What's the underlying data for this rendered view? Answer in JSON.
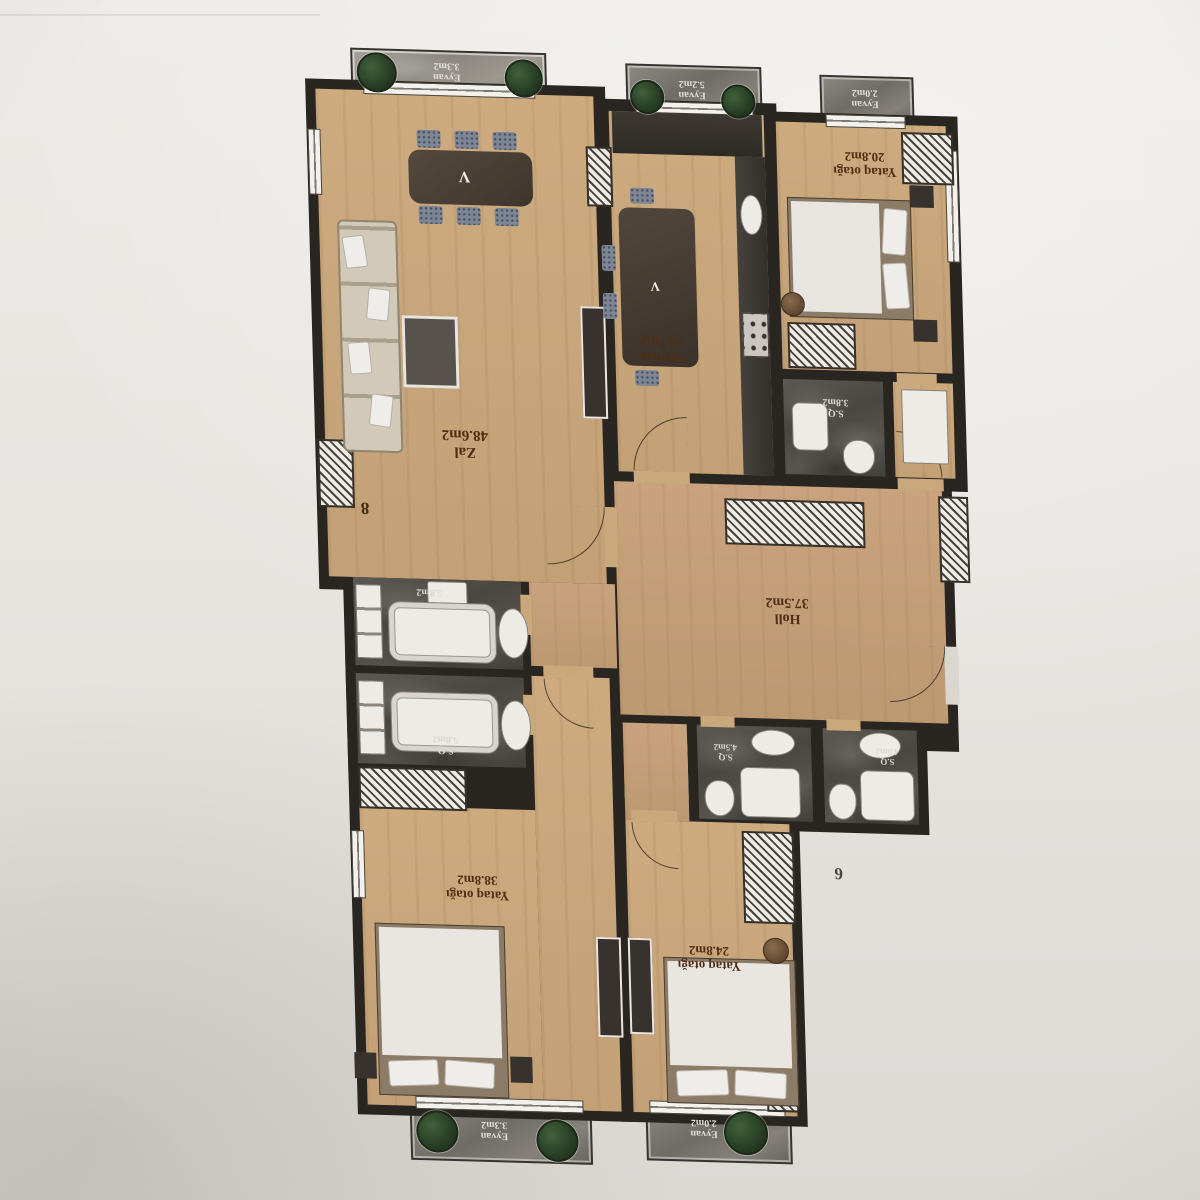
{
  "scene": {
    "description": "photo of apartment floor plan poster, plan printed upside-down",
    "colors": {
      "wall_background": "#e7e4e0",
      "plan_walls": "#292521",
      "wood_floor": "#c9a87c",
      "hall_floor": "#c3a078",
      "marble_dark": "#4c4a43",
      "marble_light": "#948f88",
      "label_text": "#4e2d14",
      "plant_green": "#2c4526"
    }
  },
  "plan": {
    "unit_numbers": [
      "8",
      "6"
    ],
    "rooms": [
      {
        "name": "Zal",
        "area": "48.6m2"
      },
      {
        "name": "Mətbəx",
        "area": "20.7m2"
      },
      {
        "name": "Yataq otağı",
        "area": "20.8m2"
      },
      {
        "name": "S.Q",
        "area": "3.8m2"
      },
      {
        "name": "Holl",
        "area": "37.5m2"
      },
      {
        "name": "",
        "area": "5.8m2"
      },
      {
        "name": "S.Q",
        "area": "5.8m2"
      },
      {
        "name": "S.Q",
        "area": "4.5m2"
      },
      {
        "name": "S.Q",
        "area": "4.6m2"
      },
      {
        "name": "Yataq otağı",
        "area": "38.8m2"
      },
      {
        "name": "Yataq otağı",
        "area": "24.8m2"
      }
    ],
    "balconies": [
      {
        "name": "Eyvan",
        "area": "3.3m2"
      },
      {
        "name": "Eyvan",
        "area": "5.2m2"
      },
      {
        "name": "Eyvan",
        "area": "2.0m2"
      },
      {
        "name": "Eyvan",
        "area": "3.3m2"
      },
      {
        "name": "Eyvan",
        "area": "2.0m2"
      }
    ]
  }
}
